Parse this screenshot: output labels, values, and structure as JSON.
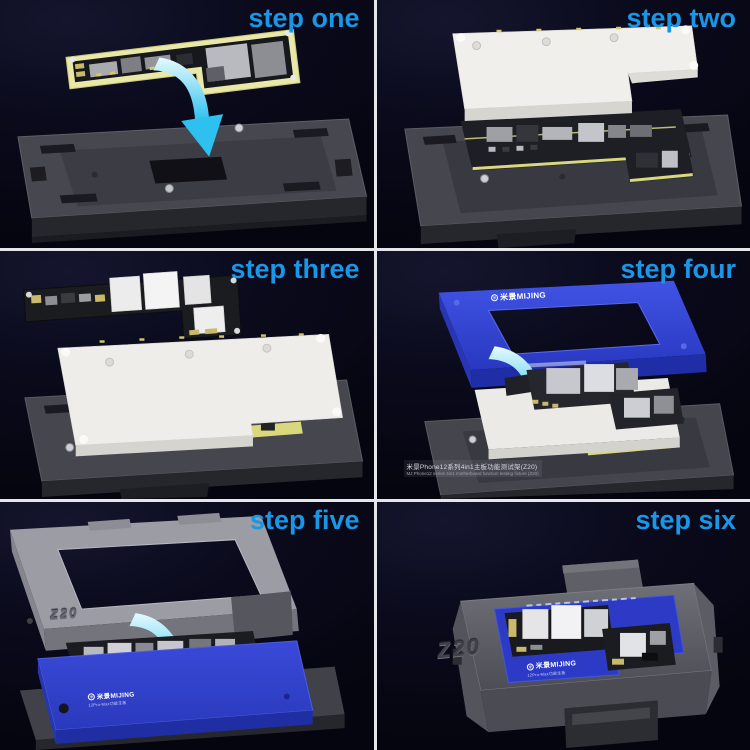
{
  "theme": {
    "accent_blue": "#1a96e6",
    "panel_background": "#0a0a1c",
    "divider": "#e6e6ea",
    "arrow_cyan": "#2ec0ef",
    "fixture_gray": "#46474f",
    "cover_white": "#efeeea",
    "frame_blue": "#3245d2",
    "pcb_gasket_yellow": "#e9e8a8"
  },
  "brand": {
    "name": "米景MIJING",
    "model": "Z20"
  },
  "panels": [
    {
      "label": "step one"
    },
    {
      "label": "step two"
    },
    {
      "label": "step three"
    },
    {
      "label": "step four",
      "logo": "米景MIJING",
      "caption": {
        "line1": "米景Phone12系列4in1主板功能测试架(Z20)",
        "line2": "MJ Phone12 series 4in1 motherboard function testing fixture (Z20)"
      }
    },
    {
      "label": "step five",
      "frame_marking": "Z20",
      "logo": "米景MIJING",
      "logo_sub": "12Pro-Max功能主板"
    },
    {
      "label": "step six",
      "case_marking": "Z20",
      "logo": "米景MIJING",
      "logo_sub": "12Pro-Max功能主板"
    }
  ]
}
